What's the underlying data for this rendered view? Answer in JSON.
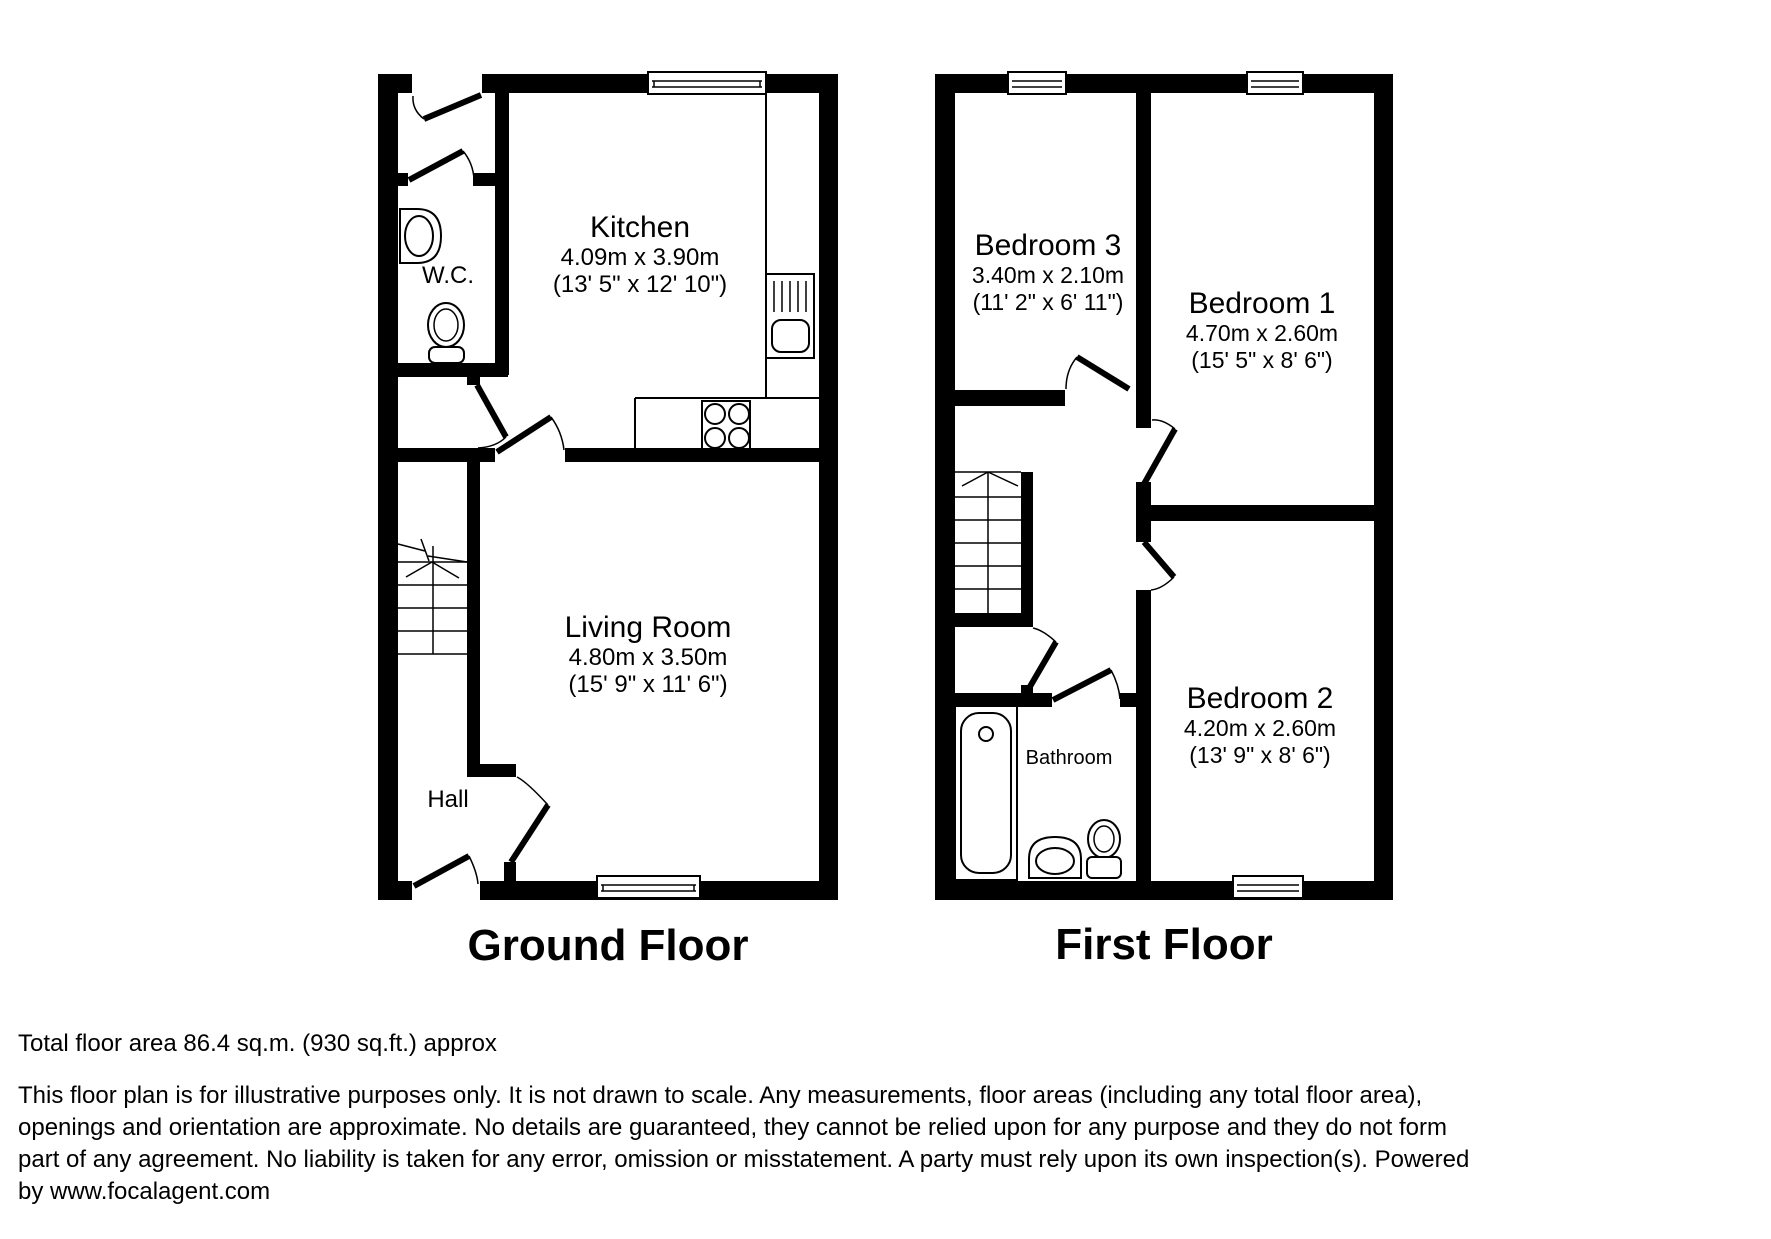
{
  "ground_floor": {
    "title": "Ground Floor",
    "rooms": {
      "kitchen": {
        "name": "Kitchen",
        "metric": "4.09m x 3.90m",
        "imperial": "(13' 5\" x 12' 10\")"
      },
      "living_room": {
        "name": "Living Room",
        "metric": "4.80m x 3.50m",
        "imperial": "(15' 9\" x 11' 6\")"
      },
      "wc": {
        "name": "W.C."
      },
      "hall": {
        "name": "Hall"
      }
    }
  },
  "first_floor": {
    "title": "First Floor",
    "rooms": {
      "bedroom3": {
        "name": "Bedroom 3",
        "metric": "3.40m x 2.10m",
        "imperial": "(11' 2\" x 6' 11\")"
      },
      "bedroom1": {
        "name": "Bedroom 1",
        "metric": "4.70m x 2.60m",
        "imperial": "(15' 5\" x 8' 6\")"
      },
      "bedroom2": {
        "name": "Bedroom 2",
        "metric": "4.20m x 2.60m",
        "imperial": "(13' 9\" x 8' 6\")"
      },
      "bathroom": {
        "name": "Bathroom"
      }
    }
  },
  "footer": {
    "total_area": "Total floor area 86.4 sq.m. (930 sq.ft.) approx",
    "disclaimer_lines": [
      "This floor plan is for illustrative purposes only. It is not drawn to scale. Any measurements, floor areas (including any total floor area),",
      "openings and orientation are approximate. No details are guaranteed, they cannot be relied upon for any purpose and they do not form",
      "part of any agreement. No liability is taken for any error, omission or misstatement. A party must rely upon its own inspection(s). Powered",
      "by www.focalagent.com"
    ]
  },
  "colors": {
    "wall": "#000000",
    "background": "#ffffff"
  }
}
